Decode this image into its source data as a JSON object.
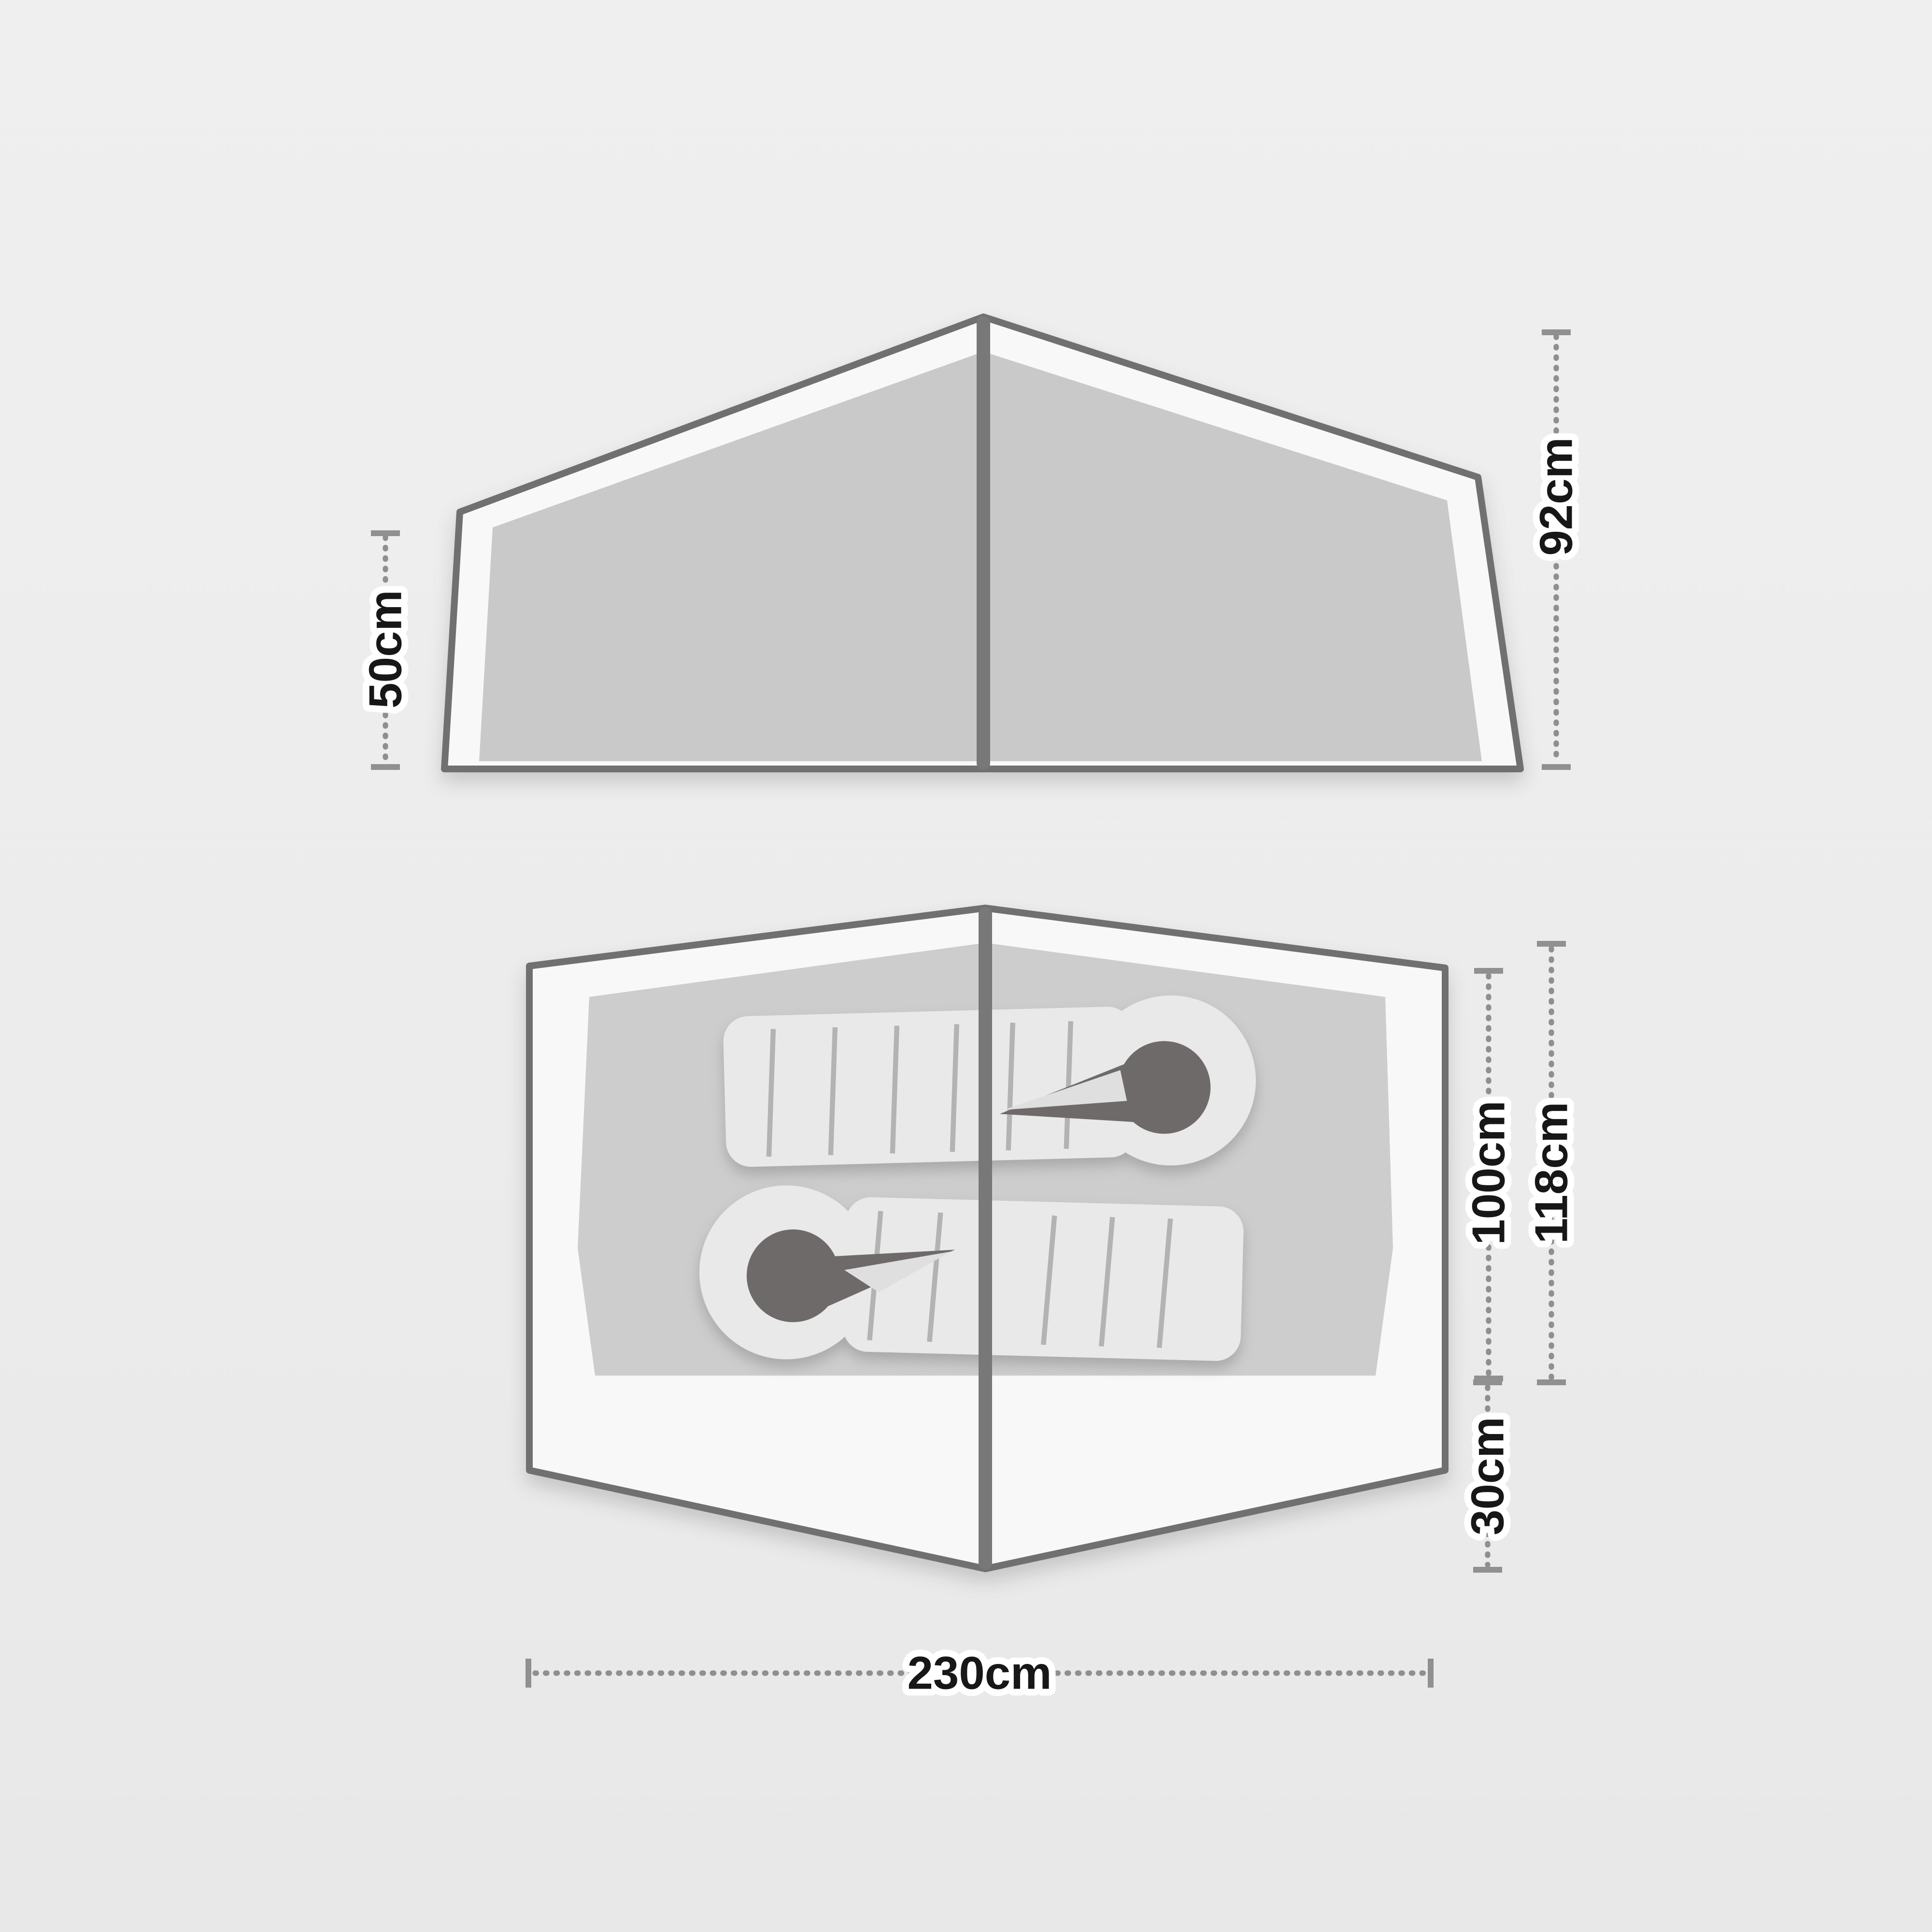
{
  "diagram": {
    "type": "tent-dimension-diagram",
    "side_view": {
      "name": "tent-side-elevation",
      "labels": {
        "wall_height": "50cm",
        "peak_height": "92cm"
      }
    },
    "floor_plan": {
      "name": "tent-floor-plan",
      "sleeping_bag_count": 2,
      "labels": {
        "inner_depth": "100cm",
        "total_depth": "118cm",
        "porch_depth": "30cm",
        "total_length": "230cm"
      }
    },
    "colors": {
      "background": "#ececec",
      "outline": "#6f6f6f",
      "center_pole": "#787878",
      "side_panel": "#c9c9c9",
      "inner_floor": "#cdcdcd",
      "flysheet_area": "#f8f8f8",
      "sleeping_bag": "#e9e9e9",
      "bag_baffle": "#b3b3b3",
      "hood_opening": "#6f6a6a",
      "hood_flap": "#dfdfdf",
      "dimension_line": "#8f8f8f",
      "label_text": "#171717"
    }
  }
}
